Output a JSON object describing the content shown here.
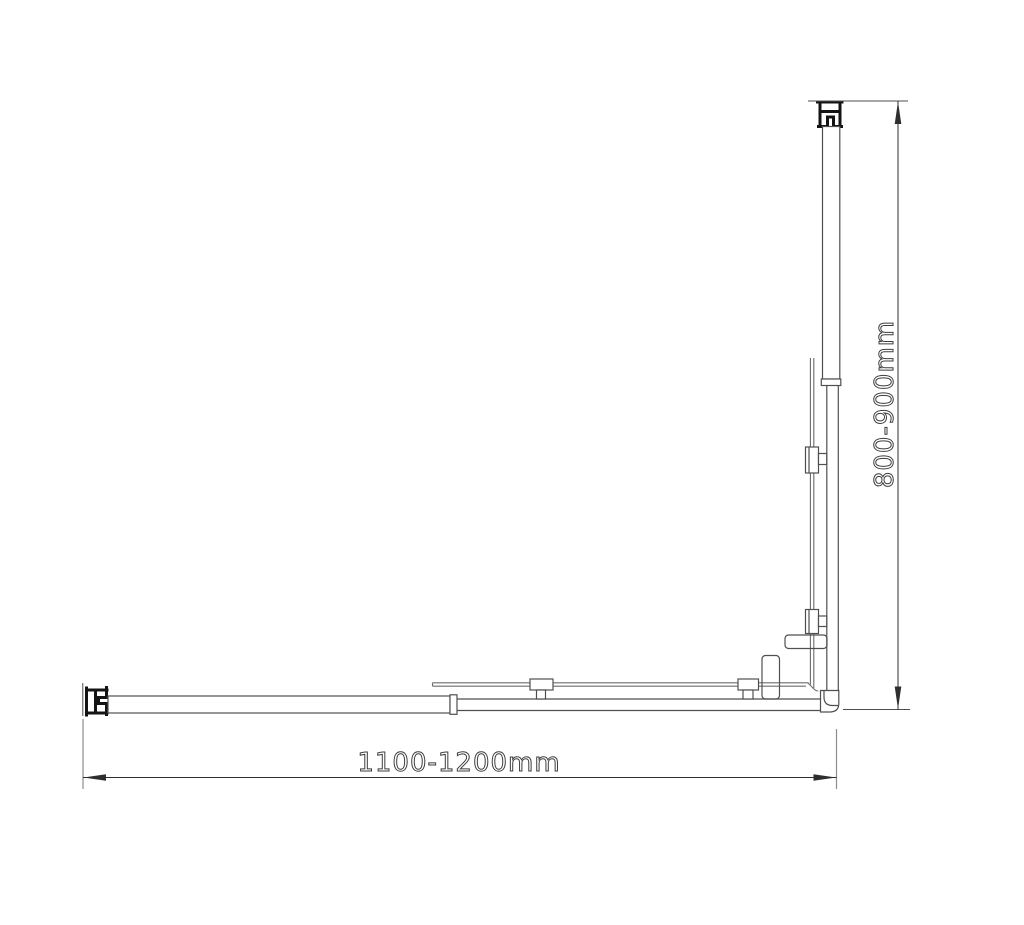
{
  "drawing": {
    "kind": "shower-enclosure-plan-view",
    "dimensions": {
      "width_label": "1100-1200mm",
      "height_label": "800-900mm"
    },
    "colors": {
      "background": "#ffffff",
      "line": "#4f4f4f",
      "glass_line": "#6b6b6b",
      "bold": "#141414",
      "dim_line": "#2e2e2e",
      "extension": "#8c8c8c",
      "text": "#3d3d3d"
    }
  }
}
